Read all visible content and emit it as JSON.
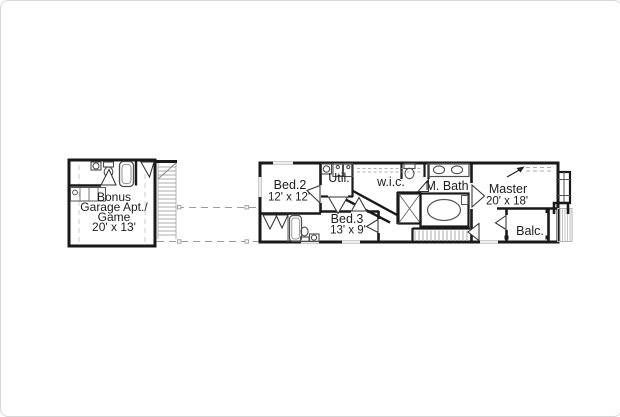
{
  "rooms": {
    "garage": {
      "line1": "Bonus",
      "line2": "Garage Apt./",
      "line3": "Game",
      "dims": "20' x 13'"
    },
    "bed2": {
      "label": "Bed.2",
      "dims": "12' x 12'"
    },
    "util": {
      "label": "Util."
    },
    "wic": {
      "label": "w.i.c."
    },
    "mbath": {
      "label": "M. Bath"
    },
    "master": {
      "label": "Master",
      "dims": "20' x 18'"
    },
    "bed3": {
      "label": "Bed.3",
      "dims": "13' x 9'"
    },
    "balc": {
      "label": "Balc."
    }
  },
  "colors": {
    "wall": "#191919",
    "fixtures": "#4d4d4d",
    "stairs": "#ababab",
    "dashed_lines": "#9a9a9a",
    "label_text": "#1c1c1c",
    "background": "#ffffff"
  }
}
